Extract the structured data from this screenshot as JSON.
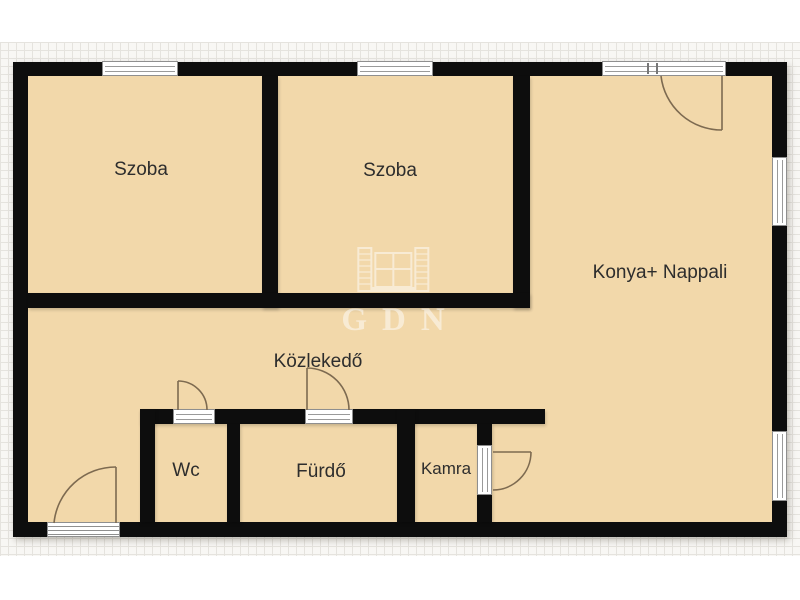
{
  "watermark": {
    "text": "GDN",
    "icon": "open-window-shutters-icon"
  },
  "rooms": [
    {
      "name": "szoba-1",
      "label": "Szoba"
    },
    {
      "name": "szoba-2",
      "label": "Szoba"
    },
    {
      "name": "konya-nappali",
      "label": "Konya+ Nappali"
    },
    {
      "name": "kozlekedo",
      "label": "Közlekedő"
    },
    {
      "name": "wc",
      "label": "Wc"
    },
    {
      "name": "furdo",
      "label": "Fürdő"
    },
    {
      "name": "kamra",
      "label": "Kamra"
    }
  ],
  "colors": {
    "wall": "#0d0d0d",
    "floor": "#f2d8aa",
    "paper": "#f8f7f4",
    "grid_line": "#e5e3de",
    "label_text": "#2d2d2d",
    "door_arc": "#7d6a50",
    "window_frame": "#8f8f8f",
    "watermark": "#ffffff"
  }
}
